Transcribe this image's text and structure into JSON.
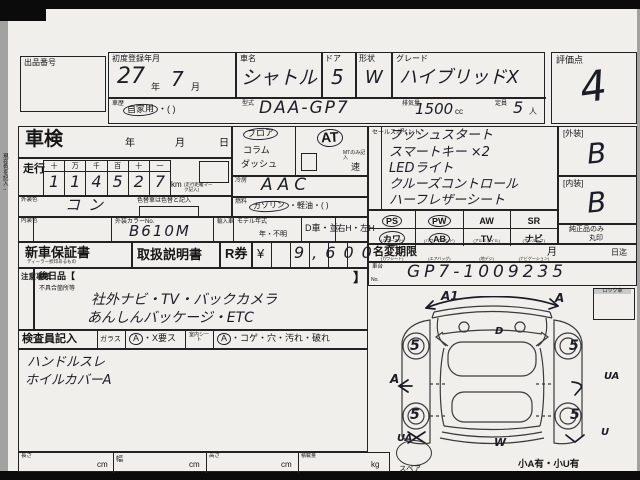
{
  "margin_note": "現在色を記入→",
  "auction": {
    "label": "出品番号"
  },
  "header": {
    "first_reg_label": "初度登録年月",
    "first_reg_year": "27",
    "year_unit": "年",
    "first_reg_month": "7",
    "month_unit": "月",
    "car_name_label": "車名",
    "car_name": "シャトル",
    "door_label": "ドア",
    "door": "5",
    "shape_label": "形状",
    "shape": "W",
    "grade_label": "グレード",
    "grade": "ハイブリッドX",
    "score_label": "評価点",
    "score": "4"
  },
  "reg2": {
    "history_label": "車歴",
    "history": "自家用",
    "history_paren": "・(        )",
    "model_label": "型式",
    "model": "DAA-GP7",
    "disp_label": "排気量",
    "disp": "1500",
    "disp_unit": "cc",
    "cap_label": "定員",
    "cap": "5",
    "cap_unit": "人"
  },
  "shaken": {
    "label": "車検",
    "year": "年",
    "month": "月",
    "day": "日"
  },
  "mileage": {
    "label": "走行",
    "cols": [
      "十",
      "万",
      "千",
      "百",
      "十",
      "一"
    ],
    "digits": [
      "1",
      "1",
      "4",
      "5",
      "2",
      "7"
    ],
    "unit": "km",
    "note": "(走行距離マーク記入)"
  },
  "colors": {
    "ext_label": "外装色",
    "ext": "コン",
    "change_note": "色替車は色替と記入",
    "int_label": "内装色",
    "int": "",
    "code_label": "外装カラーNo.",
    "code": "B610M"
  },
  "drivetrain": {
    "shift_options": [
      "フロア",
      "コラム",
      "ダッシュ"
    ],
    "trans": "AT",
    "mt_note": "MTのみ記入",
    "mt_unit": "速",
    "ac_label": "冷房",
    "ac": "AAC",
    "fuel_label": "燃料",
    "fuel1": "ガソリン",
    "fuel2": "・軽油・(      )",
    "import_label": "輸入車",
    "year_label": "モデル年式",
    "year_value": "年・不明",
    "d_car": "D車・並",
    "handle": "右H・左H"
  },
  "docs": {
    "warranty": "新車保証書",
    "warranty_sub": "ディーラー捺印あるもの",
    "manual": "取扱説明書",
    "r_ticket": "R券",
    "yen": "¥",
    "price": "9,600"
  },
  "notes": {
    "label": "注意事項",
    "later_items": "後日品【",
    "bracket": "】",
    "defects_label": "不具合箇所等",
    "hw1": "社外ナビ・TV・バックカメラ",
    "hw2": "あんしんバッケージ・ETC"
  },
  "inspector": {
    "label": "検査員記入",
    "glass_label": "ガラス",
    "glass_a": "A",
    "glass_rest": "・X要ス",
    "seat_label": "室内シート",
    "seat_a": "A",
    "seat_rest": "・コゲ・穴・汚れ・破れ",
    "hw1": "ハンドルスレ",
    "hw2": "ホイルカバーA"
  },
  "sales": {
    "label": "セールスポイント",
    "lines": [
      "プッシュスタート",
      "スマートキー ×2",
      "LEDライト",
      "クルーズコントロール",
      "ハーフレザーシート"
    ]
  },
  "equipment": {
    "row1": [
      {
        "code": "PS",
        "sub": "(パワーステ)",
        "circled": "true"
      },
      {
        "code": "PW",
        "sub": "(パワーウインド)",
        "circled": "true"
      },
      {
        "code": "AW",
        "sub": "(アルミホイル)",
        "circled": "false"
      },
      {
        "code": "SR",
        "sub": "(サンルーフ)",
        "circled": "false"
      }
    ],
    "row2": [
      {
        "code": "カワ",
        "sub": "(カワシート)",
        "circled": "true"
      },
      {
        "code": "AB",
        "sub": "(エアバッグ)",
        "circled": "true"
      },
      {
        "code": "TV",
        "sub": "(地デジ)",
        "circled": "false"
      },
      {
        "code": "ナビ",
        "sub": "(ナビゲーション)",
        "circled": "false"
      }
    ]
  },
  "name_change": {
    "label": "名変期限",
    "month": "月",
    "due": "日迄"
  },
  "chassis": {
    "label1": "車台",
    "label2": "No.",
    "value": "GP7-1009235"
  },
  "grades": {
    "ext_label": "[外装]",
    "ext": "B",
    "int_label": "[内装]",
    "int": "B",
    "genuine1": "純正品のみ",
    "genuine2": "丸印"
  },
  "diagram": {
    "lock_label": "ロック車",
    "spare_label": "スペア",
    "corner_note": "小A有・小U有",
    "marks": [
      {
        "label": "A1"
      },
      {
        "label": "A"
      },
      {
        "label": "D"
      },
      {
        "label": "5"
      },
      {
        "label": "5"
      },
      {
        "label": "A"
      },
      {
        "label": "UA"
      },
      {
        "label": "5"
      },
      {
        "label": "5"
      },
      {
        "label": "UA"
      },
      {
        "label": "U"
      },
      {
        "label": "W"
      }
    ]
  },
  "dims": {
    "len_label": "長さ",
    "len_unit": "cm",
    "wid_label": "幅",
    "wid_unit": "cm",
    "hei_label": "高さ",
    "hei_unit": "cm",
    "load_label": "積載量",
    "load_unit": "kg"
  }
}
